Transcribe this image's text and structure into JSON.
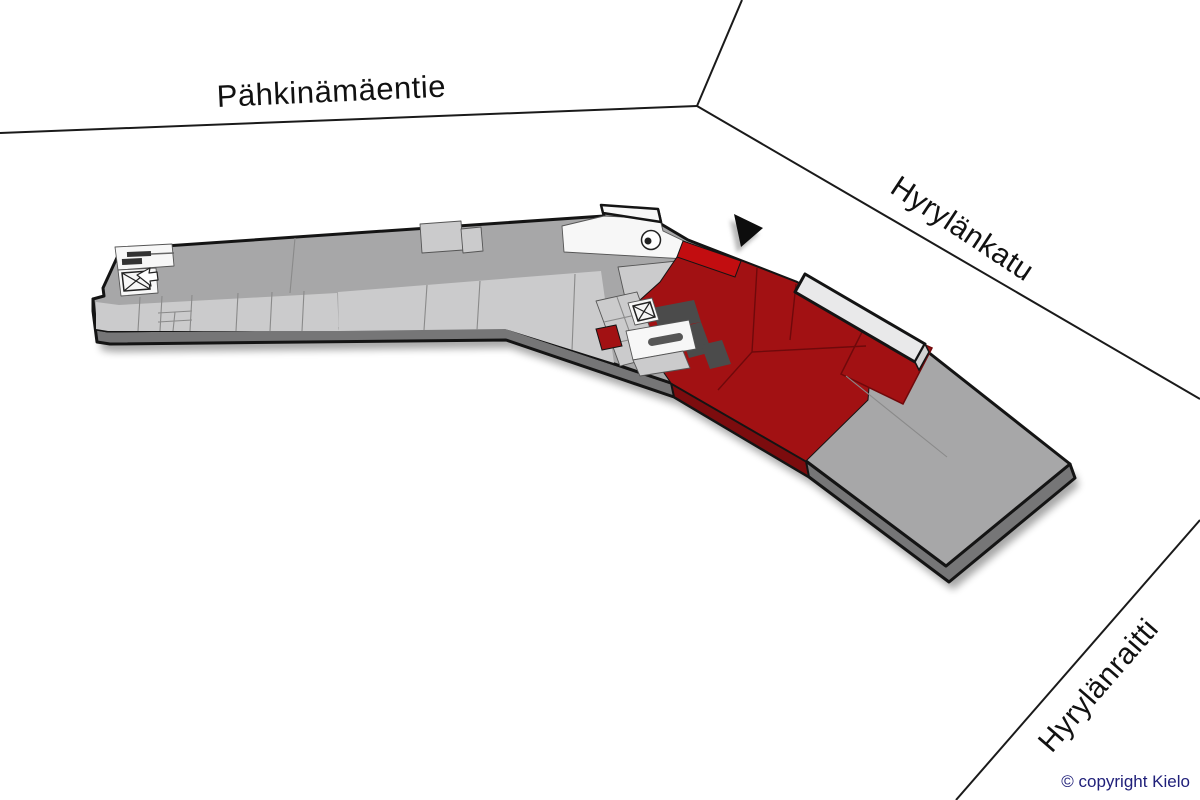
{
  "streets": {
    "top": {
      "label": "Pähkinämäentie"
    },
    "upper_right": {
      "label": "Hyrylänkatu"
    },
    "lower_right": {
      "label": "Hyrylänraitti"
    }
  },
  "footer": {
    "copyright": "© copyright Kielo"
  },
  "icons": {
    "location-marker": "filled-triangle",
    "elevator": "crossed-box",
    "stairs": "stair-bars",
    "entrance-arrow": "outlined-arrow",
    "door-swing": "circle-with-dot"
  },
  "colors": {
    "streetLine": "#1a1a1a",
    "labelText": "#111111",
    "copyrightText": "#20207a",
    "deck": "#a7a7a8",
    "roomLight": "#cbcbcc",
    "roomWhite": "#f7f7f7",
    "unitRed": "#a21113",
    "unitRedBright": "#c20d10",
    "unitRedSide": "#7c0c0e",
    "redSeam": "#6f090b",
    "darkZone": "#4b4b4b",
    "sideFace": "#767677",
    "canopy": "#e9e9ea",
    "outline": "#141414",
    "marker": "#0d0d0d",
    "seam": "#8a8a8a"
  }
}
